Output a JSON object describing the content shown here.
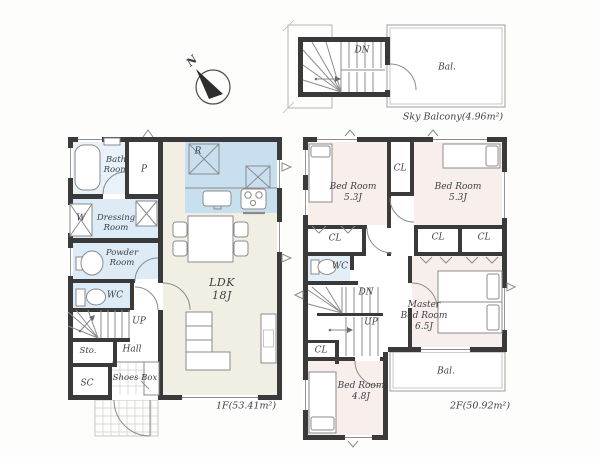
{
  "compass": {
    "north": "N"
  },
  "floor1": {
    "rooms": {
      "bath": "Bath\nRoom",
      "pantry": "P",
      "washer": "W",
      "dressing": "Dressing\nRoom",
      "powder": "Powder\nRoom",
      "wc": "WC",
      "up": "UP",
      "storage": "Sto.",
      "hall": "Hall",
      "shoe_closet": "SC",
      "shoes_box": "Shoes Box",
      "fridge": "R",
      "ldk": "LDK\n18J"
    },
    "area": "1F(53.41m²)"
  },
  "floor2": {
    "rooms": {
      "bedroom_left": "Bed Room\n5.3J",
      "closet_top": "CL",
      "bedroom_right": "Bed Room\n5.3J",
      "closet_left": "CL",
      "wc": "WC",
      "closet_mid1": "CL",
      "closet_mid2": "CL",
      "down": "DN",
      "up": "UP",
      "closet_small": "CL",
      "bedroom_small": "Bed Room\n4.8J",
      "master": "Master\nBed Room\n6.5J",
      "balcony": "Bal."
    },
    "area": "2F(50.92m²)"
  },
  "sky_balcony": {
    "down": "DN",
    "balcony": "Bal.",
    "caption": "Sky Balcony(4.96m²)"
  },
  "colors": {
    "wall": "#3a3a3a",
    "kitchen": "#c8dff0",
    "wet_room": "#dcebf5",
    "bedroom": "#f8efec",
    "ldk_floor": "#f1efe3"
  }
}
